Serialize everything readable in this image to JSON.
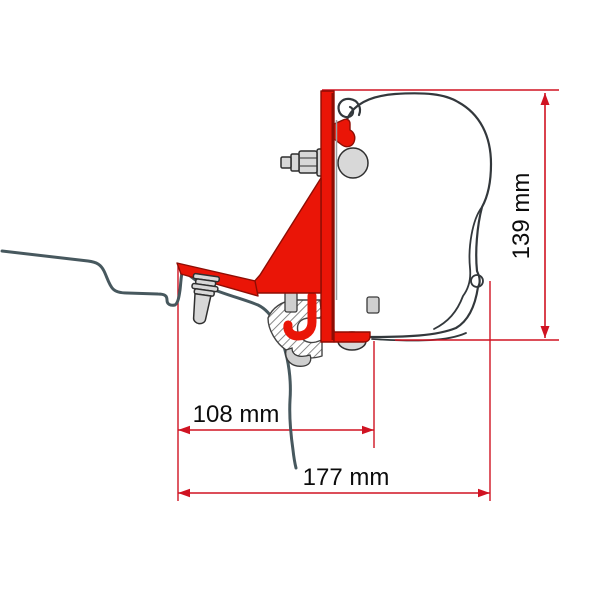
{
  "diagram": {
    "type": "technical-drawing",
    "subject": "awning-roof-bracket-adapter-side-profile",
    "dimensions": {
      "height": {
        "label": "139 mm",
        "value": 139,
        "unit": "mm",
        "orientation": "vertical"
      },
      "bracket_depth": {
        "label": "108 mm",
        "value": 108,
        "unit": "mm",
        "orientation": "horizontal"
      },
      "overall_depth": {
        "label": "177 mm",
        "value": 177,
        "unit": "mm",
        "orientation": "horizontal"
      }
    },
    "colors": {
      "bracket_red": "#ea1507",
      "bracket_red_dark": "#8e0d04",
      "dimension_red": "#d01322",
      "vehicle_line": "#47585e",
      "outline_dark": "#33383c",
      "hardware_grey": "#d8d8d8",
      "label_text": "#0c0c0c",
      "background": "#ffffff"
    }
  }
}
